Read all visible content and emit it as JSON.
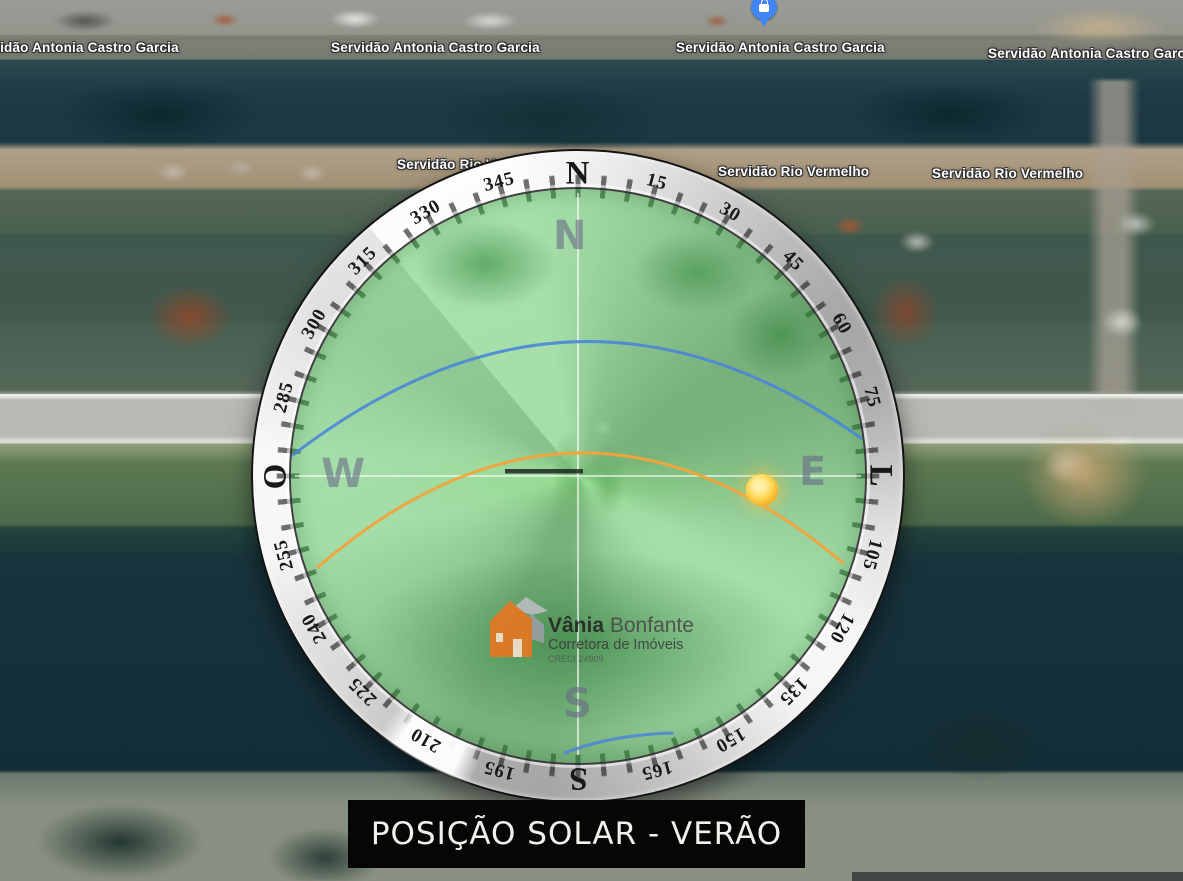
{
  "caption": {
    "text": "POSIÇÃO SOLAR - VERÃO"
  },
  "streets": {
    "antonia_castro_garcia": "Servidão Antonia Castro Garcia",
    "rio_vermelho": "Servidão Rio Vermelho"
  },
  "pin": {
    "glyph": "shopping-bag-icon",
    "color": "#4285f4"
  },
  "compass": {
    "ring_labels": [
      "N",
      "15",
      "30",
      "45",
      "60",
      "75",
      "L",
      "105",
      "120",
      "135",
      "150",
      "165",
      "S",
      "195",
      "210",
      "225",
      "240",
      "255",
      "O",
      "285",
      "300",
      "315",
      "330",
      "345"
    ],
    "inner_letters": {
      "north": "N",
      "east": "E",
      "south": "S",
      "west": "W"
    }
  },
  "sun_paths": {
    "summer_color": "#f2a33c",
    "winter_color": "#4a86d8",
    "sun_color": "#ffc233",
    "overlay_color": "#2fae3e"
  },
  "logo": {
    "icon": "house-icon",
    "name_bold": "Vânia",
    "name_regular": "Bonfante",
    "tagline": "Corretora de Imóveis",
    "license": "CRECI 24909",
    "brand_color": "#e87722"
  }
}
